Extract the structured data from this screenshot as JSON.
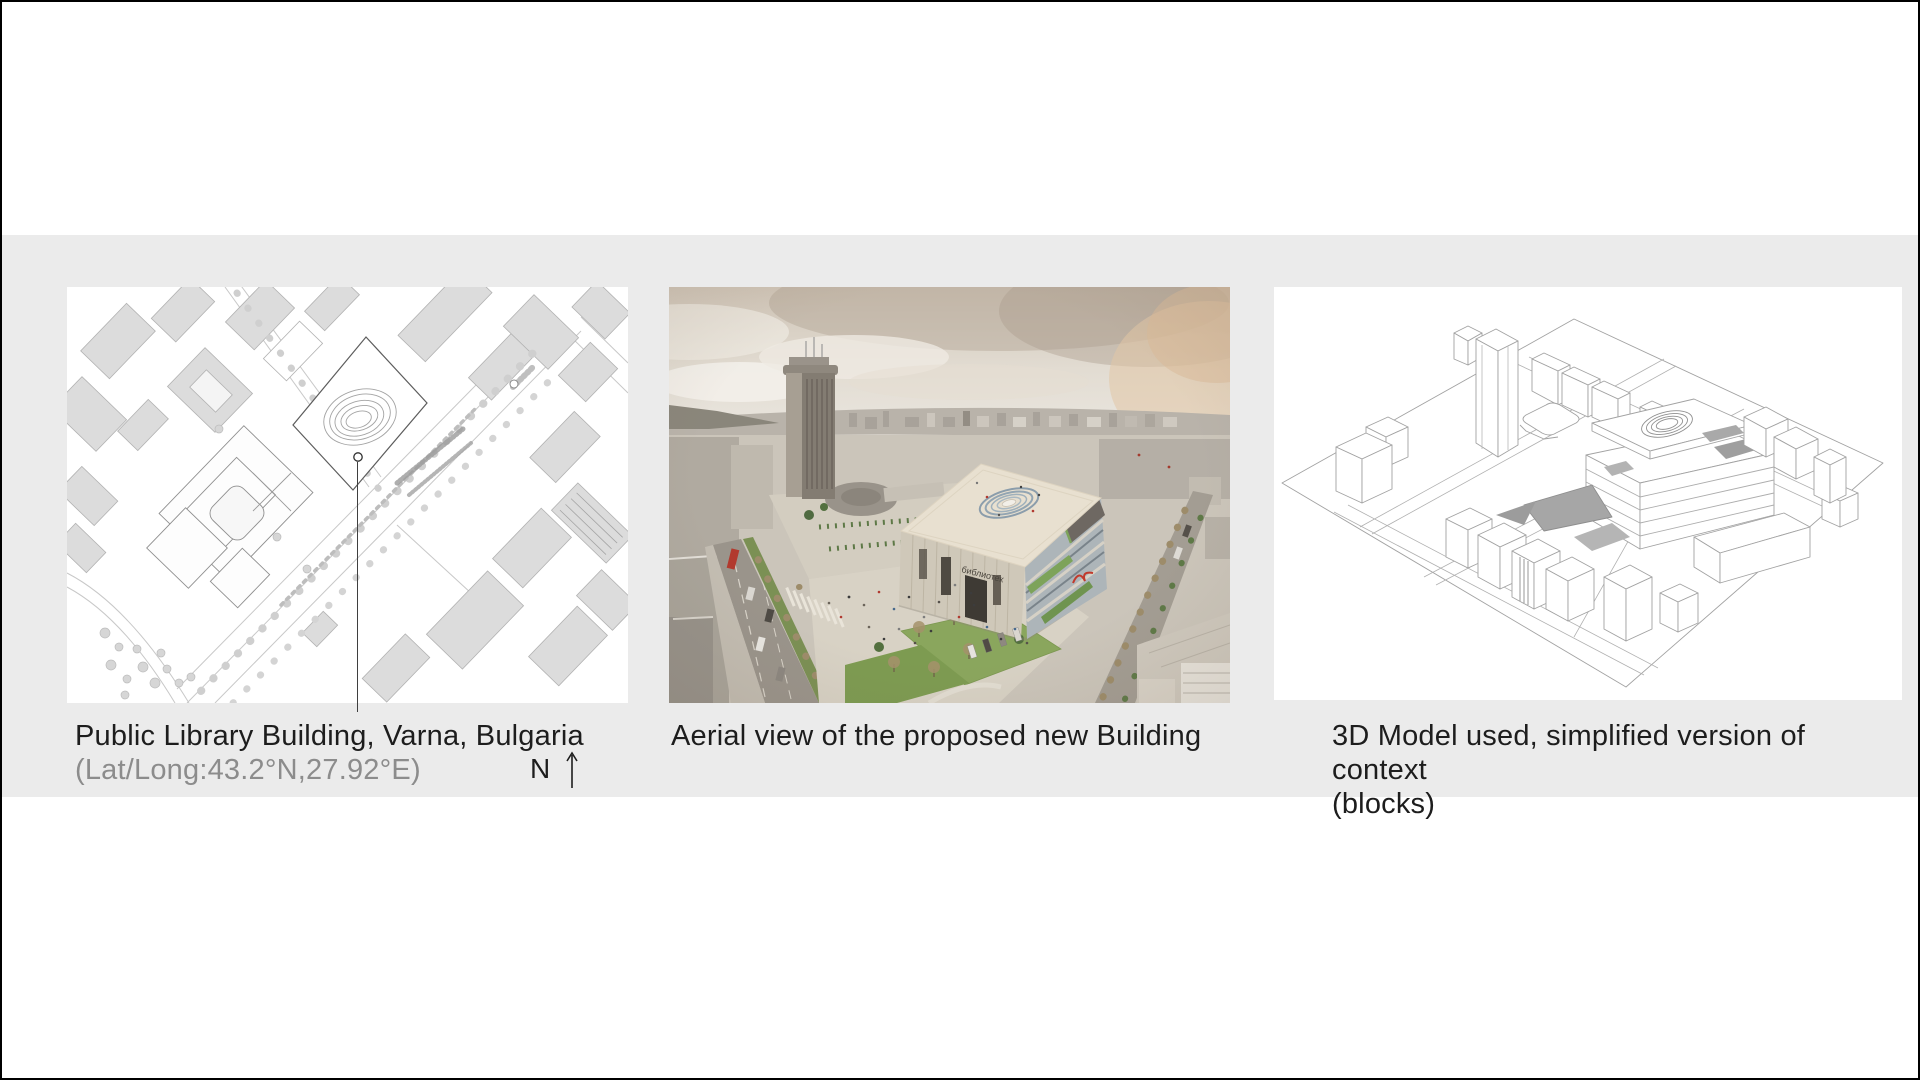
{
  "slide": {
    "type": "architecture-presentation-figure",
    "band_color": "#ebebeb",
    "background_color": "#ffffff",
    "border_color": "#000000"
  },
  "captions": {
    "site_plan_title": "Public Library Building, Varna, Bulgaria",
    "site_plan_subtitle": "(Lat/Long:43.2°N,27.92°E)",
    "north_label": "N",
    "aerial_caption": "Aerial view of the proposed new Building",
    "model_caption_line1": "3D Model used, simplified version of context",
    "model_caption_line2": "(blocks)"
  },
  "aerial": {
    "building_sign": "библиотек"
  },
  "colors": {
    "caption_text": "#1d1d1d",
    "subtitle_text": "#8c8c8c",
    "accent_red": "#c13a2c",
    "foliage_green": "#7da35a",
    "sky_warm": "#d9cfc2",
    "plan_building_gray": "#dcdcdc",
    "wireframe_stroke": "#a2a2a2"
  }
}
